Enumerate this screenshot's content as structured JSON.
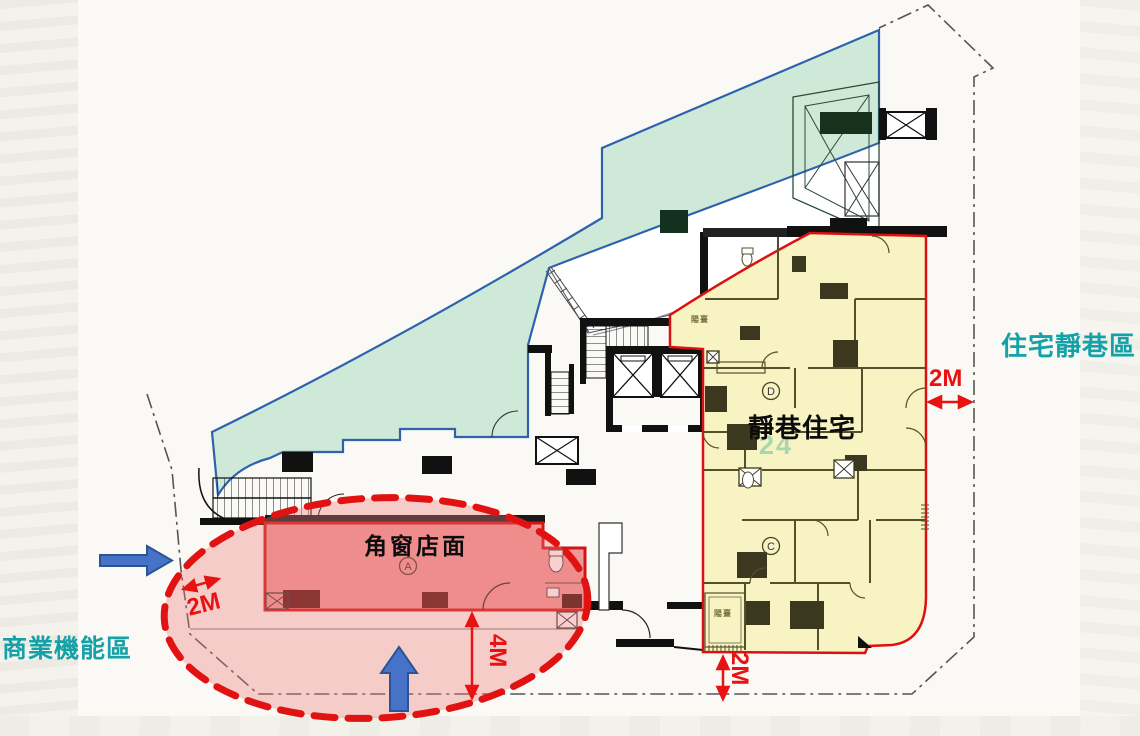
{
  "zones": {
    "residential_street_label": "住宅靜巷區",
    "commercial_function_label": "商業機能區",
    "quiet_residence_label": "靜巷住宅",
    "corner_shop_label": "角窗店面"
  },
  "dimensions": {
    "left_setback": "2M",
    "right_setback": "2M",
    "bottom_setback": "2M",
    "storefront_depth": "4M"
  },
  "plan": {
    "balcony_label": "陽臺",
    "unit_a": "A",
    "unit_c": "C",
    "unit_d": "D",
    "page_number": "24"
  },
  "colors": {
    "green_zone_fill": "#cfe9d8",
    "green_zone_border": "#2e62ad",
    "residential_fill": "#f7f3c3",
    "residential_border": "#dd1111",
    "storefront_fill": "#f09898",
    "annotation_red": "#e81212",
    "arrow_blue": "#4673c8",
    "teal_text": "#13a2a8"
  }
}
